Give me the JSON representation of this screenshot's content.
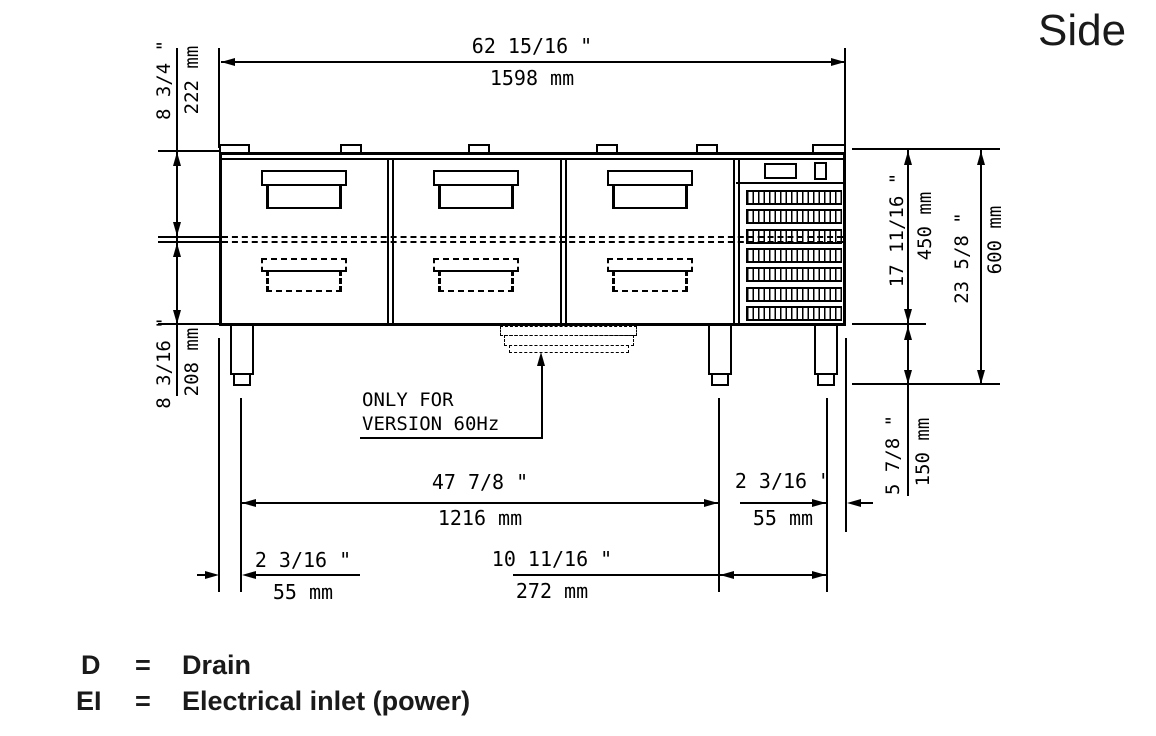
{
  "title": "Side",
  "dims": {
    "overall_width": {
      "inches": "62 15/16 \"",
      "mm": "1598 mm"
    },
    "upper_section": {
      "inches": "8 3/4 \"",
      "mm": "222 mm"
    },
    "lower_section": {
      "inches": "8 3/16 \"",
      "mm": "208 mm"
    },
    "body_height": {
      "inches": "17 11/16 \"",
      "mm": "450 mm"
    },
    "overall_height": {
      "inches": "23 5/8 \"",
      "mm": "600 mm"
    },
    "leg_height": {
      "inches": "5 7/8 \"",
      "mm": "150 mm"
    },
    "leg_span": {
      "inches": "47 7/8 \"",
      "mm": "1216 mm"
    },
    "edge_to_leg": {
      "inches": "2 3/16 \"",
      "mm": "55 mm"
    },
    "leg_to_edge": {
      "inches": "2 3/16 \"",
      "mm": "55 mm"
    },
    "rear_leg_gap": {
      "inches": "10 11/16 \"",
      "mm": "272 mm"
    }
  },
  "note": {
    "line1": "ONLY FOR",
    "line2": "VERSION 60Hz"
  },
  "legend": {
    "rows": [
      {
        "symbol": "D",
        "eq": "=",
        "label": "Drain"
      },
      {
        "symbol": "EI",
        "eq": "=",
        "label": "Electrical inlet (power)"
      }
    ]
  },
  "colors": {
    "line": "#000000",
    "background": "#ffffff"
  }
}
